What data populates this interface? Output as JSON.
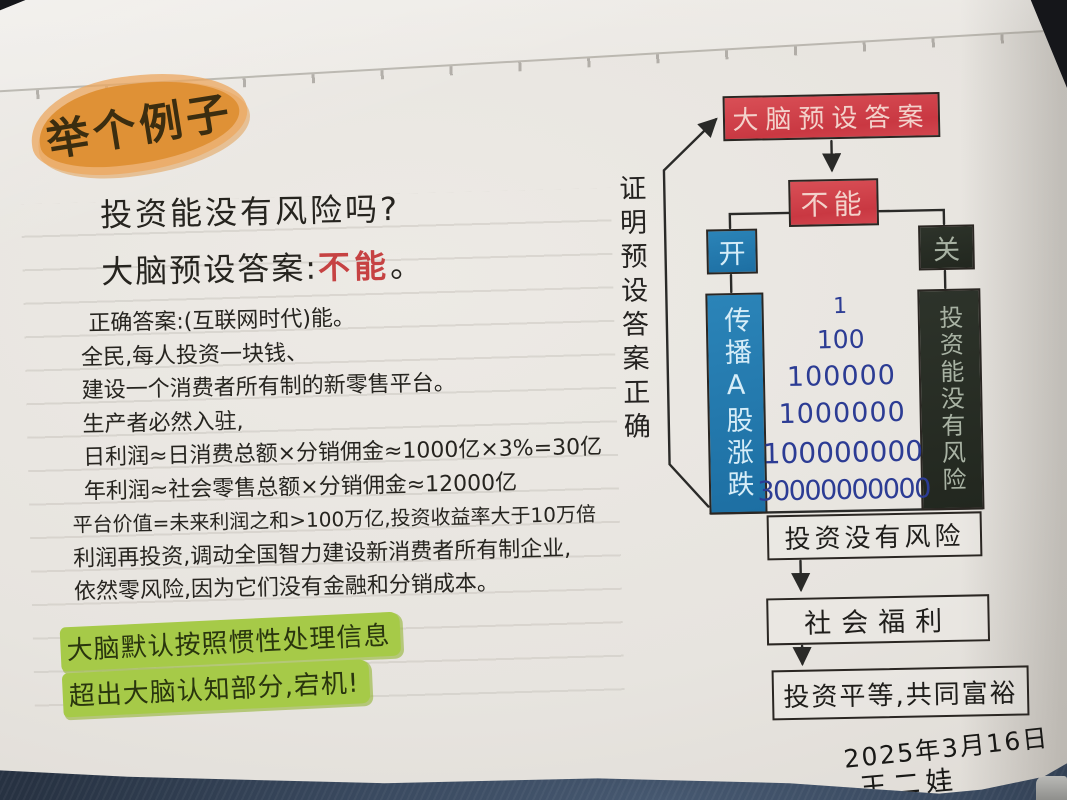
{
  "note": {
    "highlight_title": "举个例子",
    "question": "投资能没有风险吗?",
    "preset_label": "大脑预设答案:",
    "preset_answer": "不能",
    "preset_period": "。",
    "body_lines": [
      "正确答案:(互联网时代)能。",
      "全民,每人投资一块钱、",
      "建设一个消费者所有制的新零售平台。",
      "生产者必然入驻,",
      "日利润≈日消费总额×分销佣金≈1000亿×3%=30亿",
      "年利润≈社会零售总额×分销佣金≈12000亿",
      "平台价值=未来利润之和>100万亿,投资收益率大于10万倍",
      "利润再投资,调动全国智力建设新消费者所有制企业,",
      "依然零风险,因为它们没有金融和分销成本。"
    ],
    "highlight_lines": [
      "大脑默认按照惯性处理信息",
      "超出大脑认知部分,宕机!"
    ],
    "date": "2025年3月16日",
    "signature": "王二娃"
  },
  "flowchart": {
    "loop_label": "证明预设答案正确",
    "top_box": "大脑预设答案",
    "answer_box": "不能",
    "switch_open": "开",
    "switch_close": "关",
    "left_bar": "传播A股涨跌",
    "right_bar": "投资能没有风险",
    "numbers": [
      "1",
      "100",
      "100000",
      "1000000",
      "100000000",
      "30000000000"
    ],
    "result_boxes": [
      "投资没有风险",
      "社会福利",
      "投资平等,共同富裕"
    ]
  },
  "colors": {
    "highlight_orange": "#df9136",
    "highlight_green": "#a6ca48",
    "box_red": "#d2454e",
    "box_blue": "#2176a6",
    "box_dark": "#272d24",
    "ink_black": "#26241f",
    "ink_red": "#c64242",
    "ink_blue_numbers": "#2c3c94",
    "paper": "#e8e5e0",
    "denim": "#3c4d63"
  }
}
